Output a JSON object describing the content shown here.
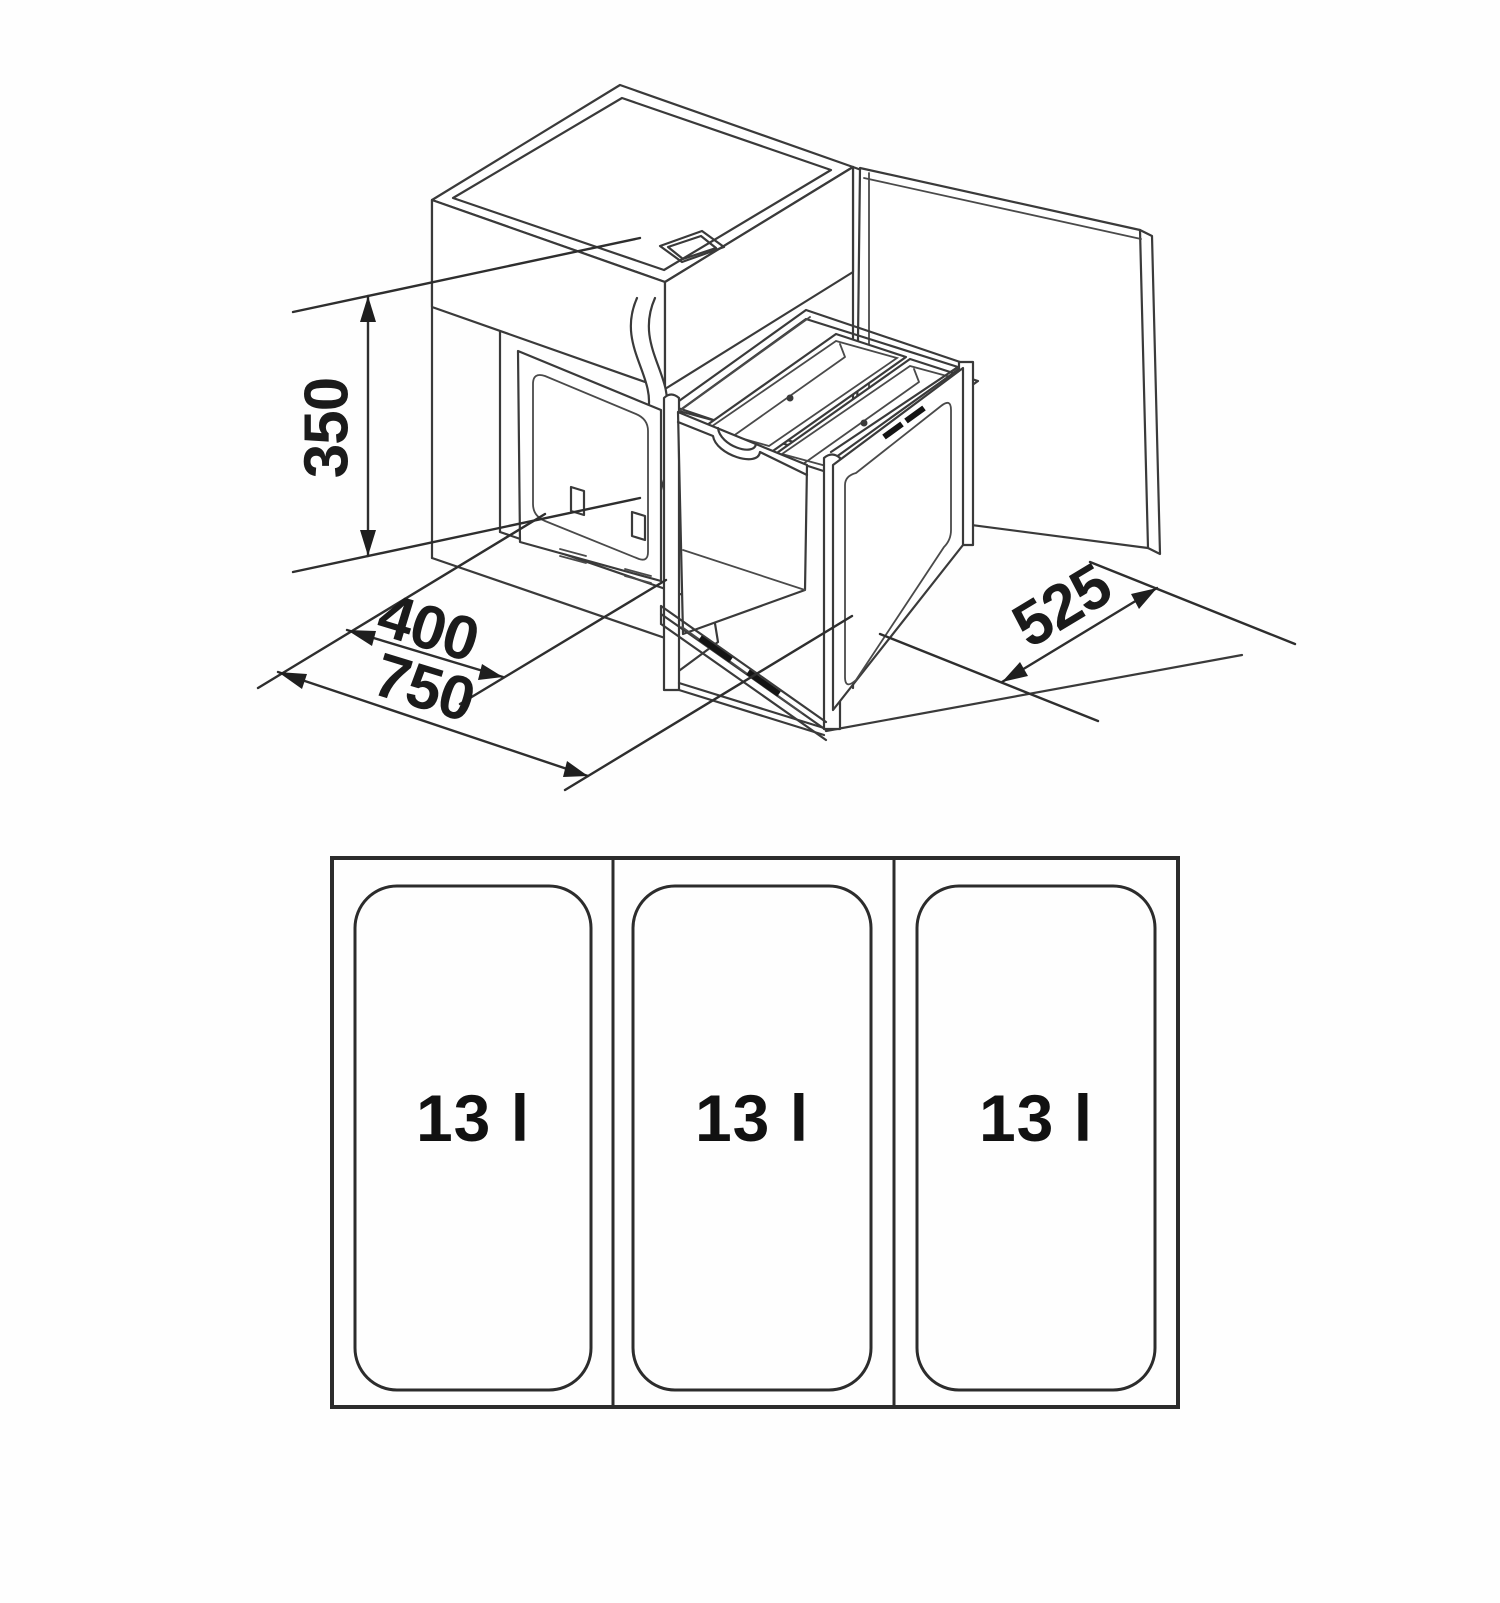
{
  "diagram": {
    "type": "installation-drawing",
    "subject": "under-sink pull-out waste separation unit with three bins",
    "dimensions": {
      "height_mm": "350",
      "front_width_mm": "400",
      "cabinet_width_mm": "750",
      "depth_mm": "525"
    },
    "plan_view": {
      "bins": [
        {
          "label": "13 l"
        },
        {
          "label": "13 l"
        },
        {
          "label": "13 l"
        }
      ]
    },
    "colors": {
      "line": "#3a3a3a",
      "text": "#1b1b1b",
      "background": "#fefefe"
    }
  }
}
